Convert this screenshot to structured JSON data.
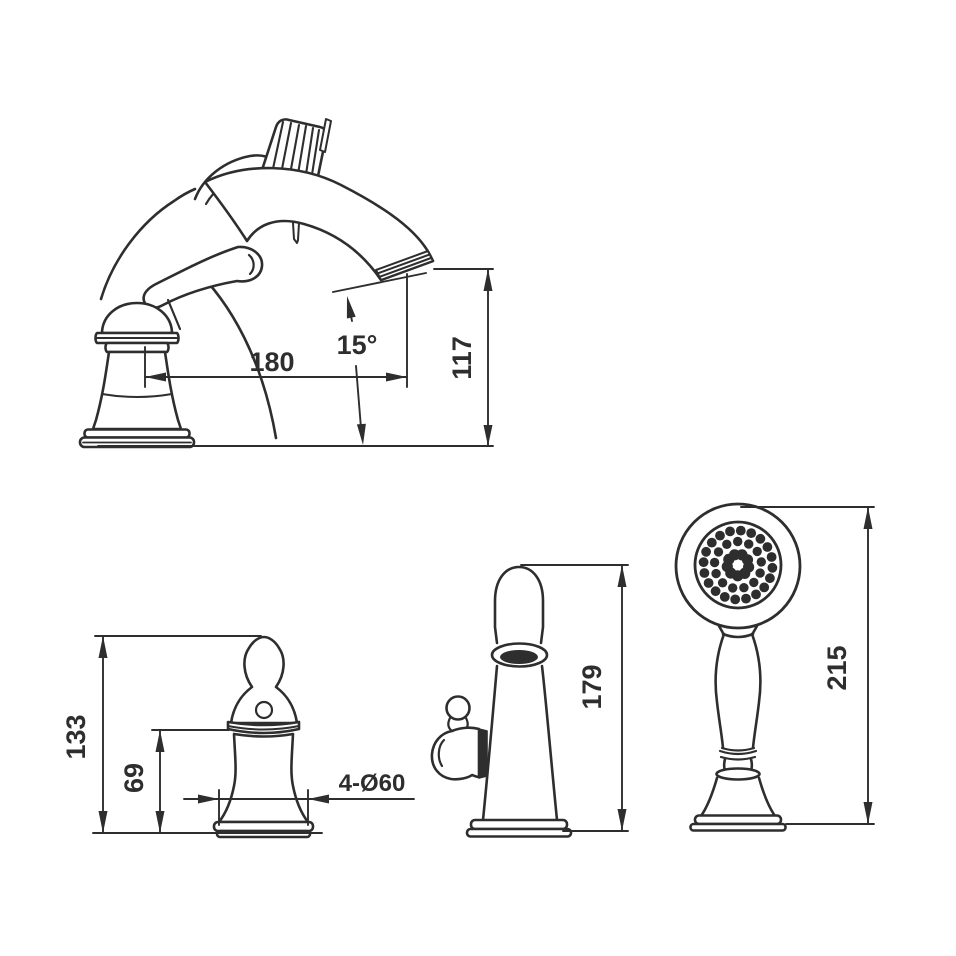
{
  "palette": {
    "background": "#ffffff",
    "line": "#2e2e2e"
  },
  "views": {
    "faucet_side_view": {
      "dims": {
        "reach": "180",
        "angle": "15°",
        "height": "117"
      }
    },
    "handle_front_view": {
      "dims": {
        "total_height": "133",
        "body_height": "69",
        "mount_holes": "4-Ø60"
      }
    },
    "spray_holder_side_view": {
      "dims": {
        "height": "179"
      }
    },
    "hand_shower_front_view": {
      "dims": {
        "height": "215"
      },
      "nozzles": {
        "center": [
          738,
          565
        ],
        "center_hole_r": 4.8,
        "rings": [
          {
            "count": 20,
            "radius": 34.5,
            "dot_r": 4.9,
            "phase": 0.08
          },
          {
            "count": 13,
            "radius": 23.5,
            "dot_r": 4.7,
            "phase": 0.35
          },
          {
            "count": 9,
            "radius": 10.8,
            "dot_r": 5.6,
            "phase": 0.2
          }
        ]
      }
    }
  }
}
